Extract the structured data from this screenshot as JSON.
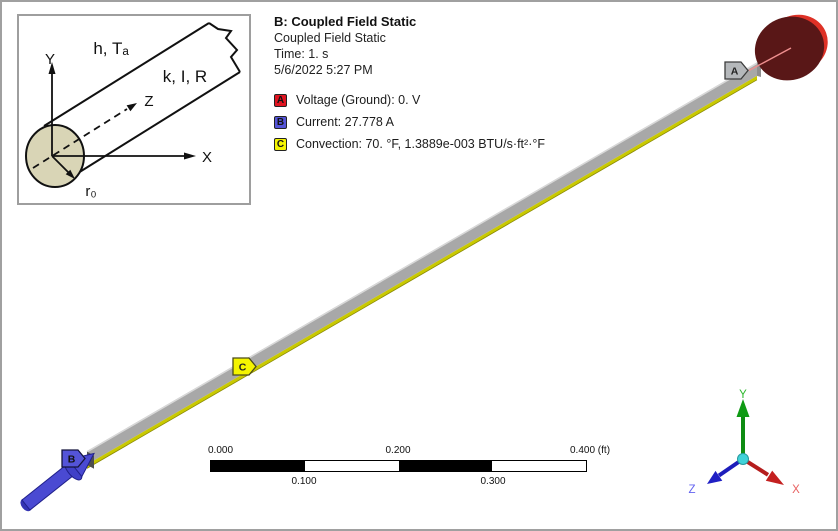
{
  "inset": {
    "labels": {
      "film": "h, Tₐ",
      "conductor": "k, I, R",
      "axis_y": "Y",
      "axis_z": "Z",
      "axis_x": "X",
      "radius": "r₀"
    },
    "section_fill": "#d9d5b6"
  },
  "header": {
    "title": "B: Coupled Field Static",
    "subtitle": "Coupled Field Static",
    "time_line": "Time: 1. s",
    "date_line": "5/6/2022 5:27 PM"
  },
  "legend": {
    "items": [
      {
        "key": "A",
        "color": "#e01420",
        "label": "Voltage (Ground): 0. V"
      },
      {
        "key": "B",
        "color": "#5454d8",
        "label": "Current: 27.778 A"
      },
      {
        "key": "C",
        "color": "#f4f400",
        "label": "Convection: 70. °F, 1.3889e-003 BTU/s·ft²·°F"
      }
    ]
  },
  "viewport": {
    "tags": {
      "a": "A",
      "b": "B",
      "c": "C"
    },
    "colors": {
      "rod": "#a8a8a8",
      "rod_edge": "#c9c900",
      "rod_highlight": "#d8d8d8",
      "disk": "#591717",
      "disk_rim": "#de3126",
      "lead_line": "#ef8f8f",
      "arrow": "#4a4ad2",
      "arrow_dark": "#20208a",
      "tag_a_fill": "#b5b8bb",
      "tag_b_fill": "#5454d8",
      "tag_c_fill": "#f4f400"
    }
  },
  "ruler": {
    "top_labels": [
      "0.000",
      "0.200",
      "0.400 (ft)"
    ],
    "bottom_labels": [
      "0.100",
      "0.300"
    ]
  },
  "triad": {
    "labels": {
      "x": "X",
      "y": "Y",
      "z": "Z"
    },
    "colors": {
      "x": "#c42020",
      "y": "#0f9a14",
      "z": "#2020c4",
      "ball": "#41d3d9"
    }
  }
}
